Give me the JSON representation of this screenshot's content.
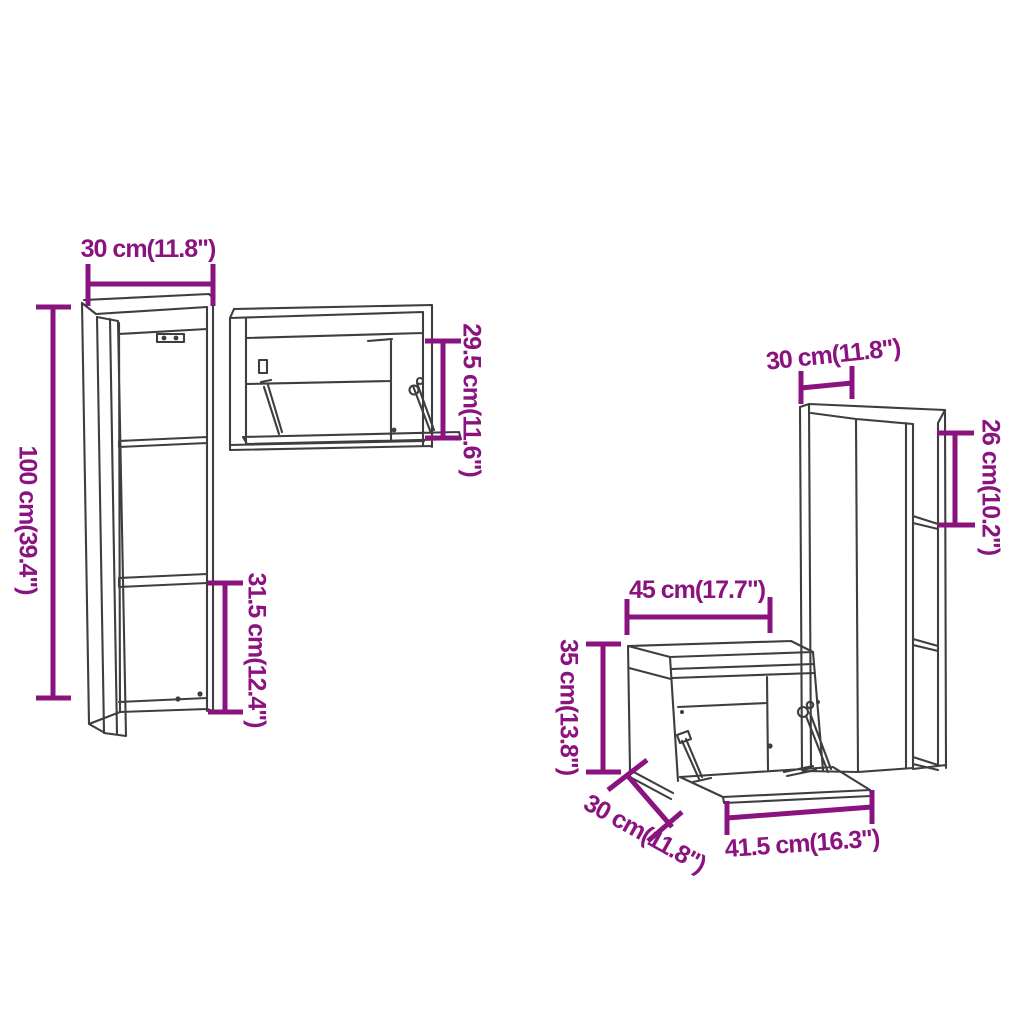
{
  "diagram": {
    "type": "furniture-dimension-diagram",
    "background_color": "#ffffff",
    "line_color": "#3e3e3e",
    "dimension_color": "#8a137f",
    "labels": {
      "cabinet_a_width": "30 cm(11.8\")",
      "cabinet_a_height": "100 cm(39.4\")",
      "cabinet_a_lower_section": "31.5 cm(12.4\")",
      "cabinet_b_opening_height": "29.5 cm(11.6\")",
      "cabinet_c_width": "30 cm(11.8\")",
      "cabinet_c_top_section": "26 cm(10.2\")",
      "cabinet_d_width": "45 cm(17.7\")",
      "cabinet_d_height": "35 cm(13.8\")",
      "cabinet_d_depth": "30 cm(11.8\")",
      "cabinet_d_flap_width": "41.5 cm(16.3\")"
    }
  }
}
